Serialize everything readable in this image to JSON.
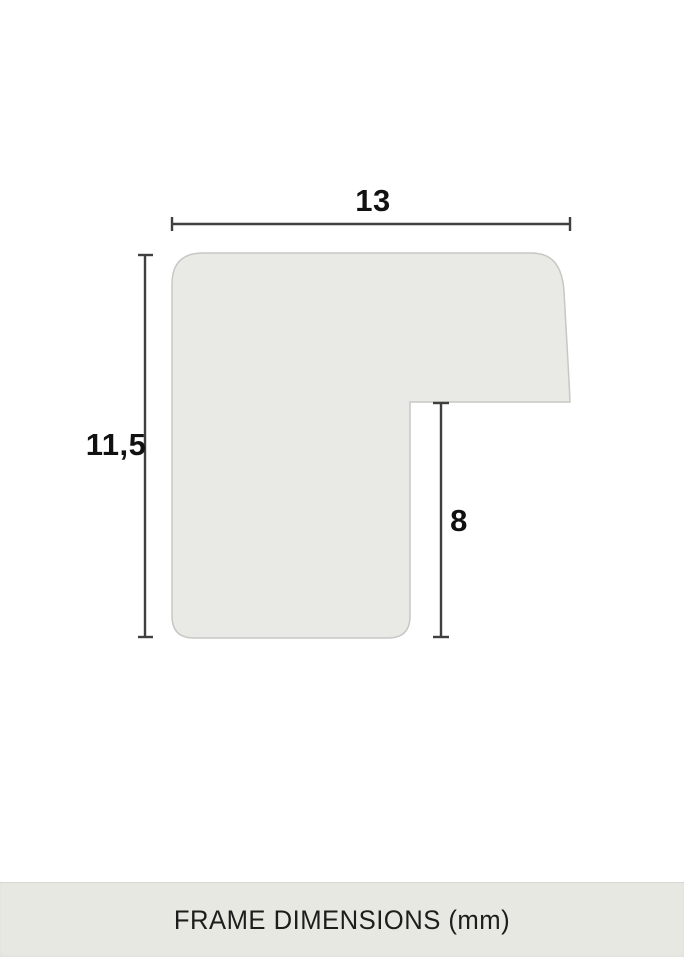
{
  "diagram": {
    "width_label": "13",
    "height_label": "11,5",
    "rabbet_label": "8"
  },
  "footer": {
    "caption": "FRAME DIMENSIONS (mm)"
  },
  "colors": {
    "background": "#ffffff",
    "profile_fill": "#e9e9e5",
    "profile_stroke": "#c7c7c3",
    "dimension_line": "#3f3f3f",
    "label_text": "#111111",
    "footer_background": "#e8e8e3",
    "footer_text": "#1d1d1b"
  }
}
